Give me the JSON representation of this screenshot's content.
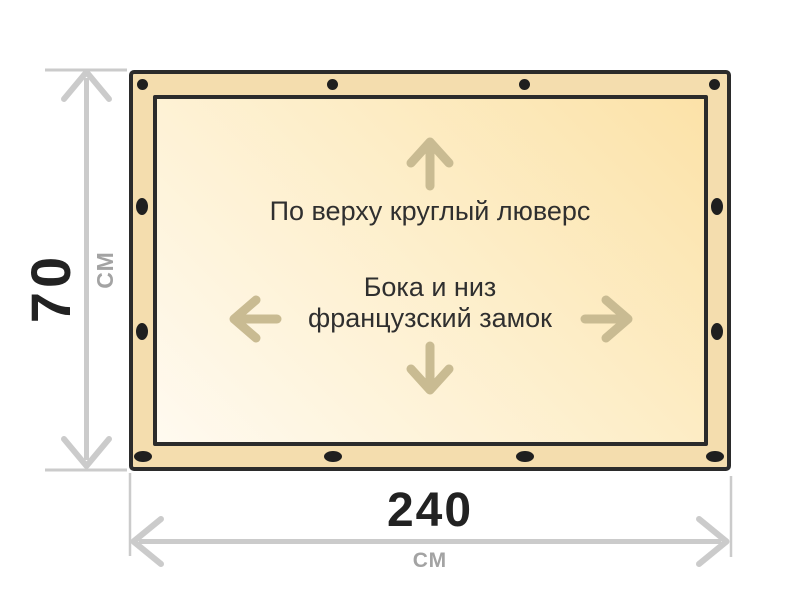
{
  "diagram": {
    "notes": {
      "top": "По верху круглый люверс",
      "center_line1": "Бока и низ",
      "center_line2": "французский замок"
    },
    "dimensions": {
      "height": {
        "value": "70",
        "unit": "СМ"
      },
      "width": {
        "value": "240",
        "unit": "СМ"
      }
    },
    "grommets": {
      "top_shape": "round",
      "side_shape": "vertical-oval",
      "bottom_shape": "horizontal-oval",
      "top_count": 4,
      "left_count": 2,
      "right_count": 2,
      "bottom_count": 4
    },
    "icons": {
      "up": "arrow-up-icon",
      "down": "arrow-down-icon",
      "left": "arrow-left-icon",
      "right": "arrow-right-icon"
    },
    "colors": {
      "tarp_border": "#2b2b2b",
      "tarp_margin": "#f4ddae",
      "tarp_fill_light": "#fffaf0",
      "tarp_fill_dark": "#fce2a8",
      "grommet": "#1f1f1f",
      "arrow_accent": "#c9bb92",
      "dimension_gray": "#cbcbcb",
      "number_text": "#222222",
      "unit_text": "#a3a3a3",
      "note_text": "#2f2f2f",
      "background": "#ffffff"
    }
  }
}
